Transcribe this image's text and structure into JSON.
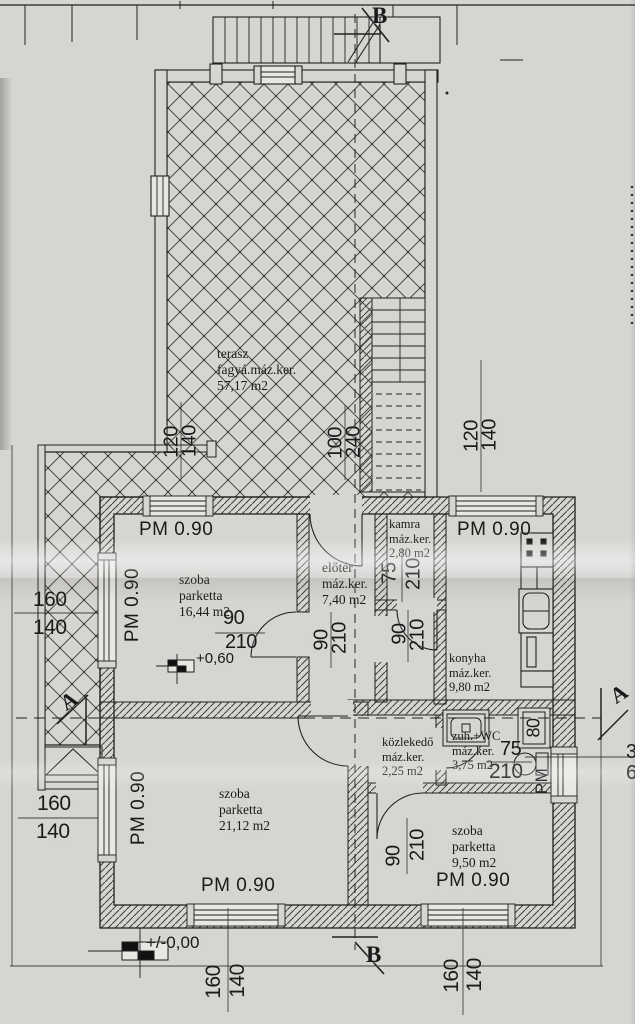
{
  "rooms": {
    "terasz": {
      "name": "terasz",
      "finish": "fagyá.máz.ker.",
      "area": "57,17 m2"
    },
    "szoba_nw": {
      "name": "szoba",
      "finish": "parketta",
      "area": "16,44 m2"
    },
    "eloter": {
      "name": "előtér",
      "finish": "máz.ker.",
      "area": "7,40 m2"
    },
    "kamra": {
      "name": "kamra",
      "finish": "máz.ker.",
      "area": "2,80 m2"
    },
    "konyha": {
      "name": "konyha",
      "finish": "máz.ker.",
      "area": "9,80 m2"
    },
    "kozlekedo": {
      "name": "közlekedő",
      "finish": "máz.ker.",
      "area": "2,25 m2"
    },
    "zuh_wc": {
      "name": "zuh.+WC",
      "finish": "máz.ker.",
      "area": "3,75 m2"
    },
    "szoba_sw": {
      "name": "szoba",
      "finish": "parketta",
      "area": "21,12 m2"
    },
    "szoba_se": {
      "name": "szoba",
      "finish": "parketta",
      "area": "9,50 m2"
    }
  },
  "parapet": {
    "label": "PM 0.90",
    "short": "PM"
  },
  "openings": {
    "door_90": {
      "w": "90",
      "h": "210"
    },
    "door_75": {
      "w": "75",
      "h": "210"
    },
    "door_100": {
      "w": "100",
      "h": "240"
    },
    "basin_80": "80",
    "win_120": {
      "w": "120",
      "h": "140"
    },
    "win_160": {
      "w": "160",
      "h": "140"
    }
  },
  "levels": {
    "upper": "+0,60",
    "ground": "+/-0,00"
  },
  "sections": {
    "a": "A",
    "b": "B"
  },
  "edge_numbers": {
    "top": "3",
    "bottom": "6"
  },
  "colors": {
    "paper": "#d6d5d2",
    "ink": "#1f1f1f"
  }
}
